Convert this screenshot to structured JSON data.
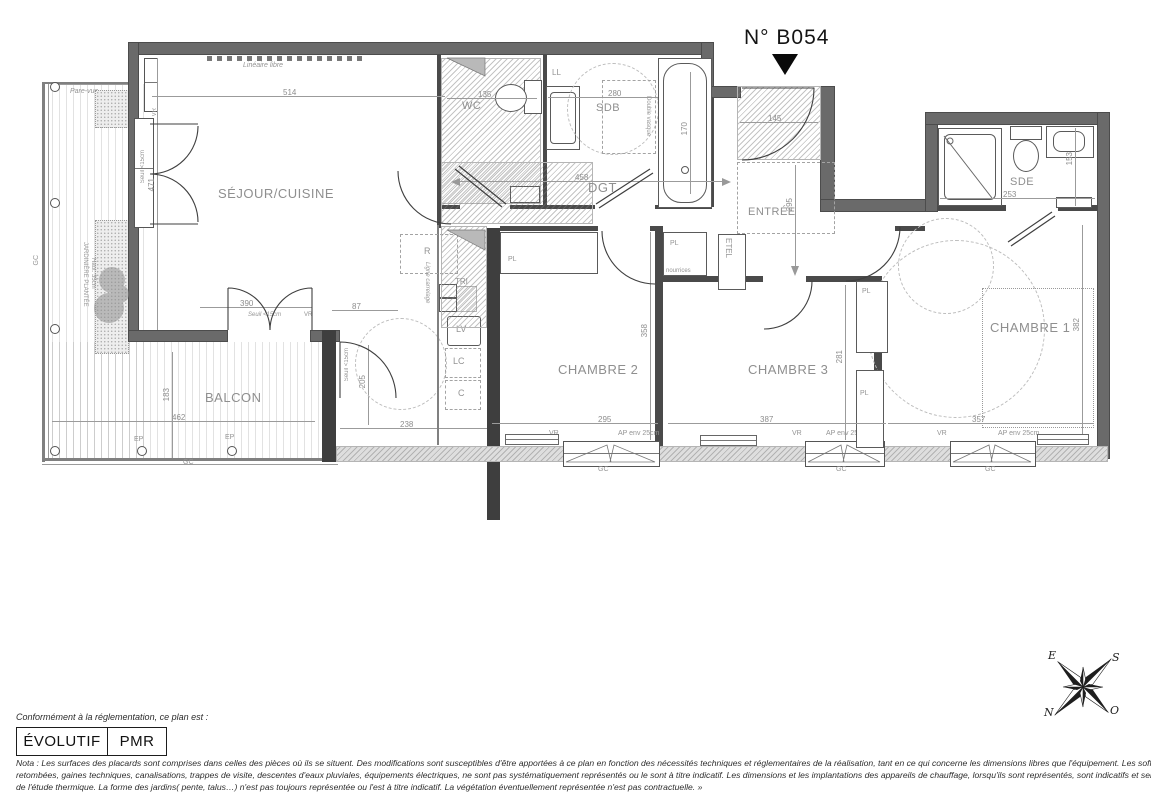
{
  "meta": {
    "unit_number": "N° B054"
  },
  "rooms": {
    "sejour": "SÉJOUR/CUISINE",
    "balcon": "BALCON",
    "wc": "WC",
    "sdb": "SDB",
    "dgt": "DGT",
    "entree": "ENTRÉE",
    "sde": "SDE",
    "chambre1": "CHAMBRE 1",
    "chambre2": "CHAMBRE 2",
    "chambre3": "CHAMBRE 3"
  },
  "dimensions": {
    "sejour_width": "514",
    "sejour_height": "471",
    "sejour_bay": "390",
    "kitchen_offset": "87",
    "kitchen_width": "238",
    "kitchen_door": "205",
    "balcon_length": "462",
    "balcon_depth": "183",
    "wc_width": "135",
    "sdb_width": "280",
    "bath_length": "170",
    "dgt_length": "458",
    "entree_width": "145",
    "entree_depth": "295",
    "sde_width": "253",
    "sde_depth": "153",
    "chambre1_depth": "382",
    "chambre1_width": "357",
    "chambre2_width": "295",
    "chambre2_depth": "358",
    "chambre3_width": "387",
    "chambre3_depth": "281"
  },
  "annotations": {
    "lineaire_libre": "Linéaire libre",
    "pare_vue": "Pare-vue",
    "jardiniere": "JARDINIÈRE PLANTÉE",
    "jardiniere_h": "Haut. 35cm",
    "seuil": "Seuil <15cm",
    "ligne_carrelage": "Ligne carrelage",
    "double_vasque": "Double vasque",
    "nourrices": "nourrices",
    "refrigerateur": "R",
    "tri": "TRI",
    "lave_vaisselle": "LV",
    "lave_cuisine": "LC",
    "cellier": "C",
    "lave_linge": "LL",
    "etel": "ETEL",
    "placard": "PL",
    "volet_roulant": "VR",
    "garde_corps": "GC",
    "eaux_pluviales": "EP",
    "allege": "AP env 25cm"
  },
  "compass": {
    "n": "N",
    "s": "S",
    "e": "E",
    "o": "O"
  },
  "legend": {
    "caption": "Conformément à la réglementation, ce plan est :",
    "evolutif": "ÉVOLUTIF",
    "pmr": "PMR"
  },
  "nota": {
    "line1": "Nota : Les surfaces des placards sont comprises dans celles des pièces où ils se situent. Des modifications sont susceptibles d'être apportées à ce plan en fonction des nécessités techniques et réglementaires de la réalisation, tant en ce qui concerne les dimensions libres que l'équipement.  Les soffites, faux-plafonds,",
    "line2": "retombées, gaines techniques, canalisations, trappes de visite, descentes d'eaux pluviales, équipements électriques, ne sont pas systématiquement représentés ou le sont à titre indicatif. Les dimensions et les implantations des appareils de chauffage, lorsqu'ils sont représentés, sont indicatifs et seront soumis à la conformité",
    "line3": "de l'étude thermique. La forme des jardins( pente, talus…) n'est pas toujours représentée ou l'est à titre indicatif. La végétation éventuellement représentée n'est pas contractuelle. »"
  }
}
